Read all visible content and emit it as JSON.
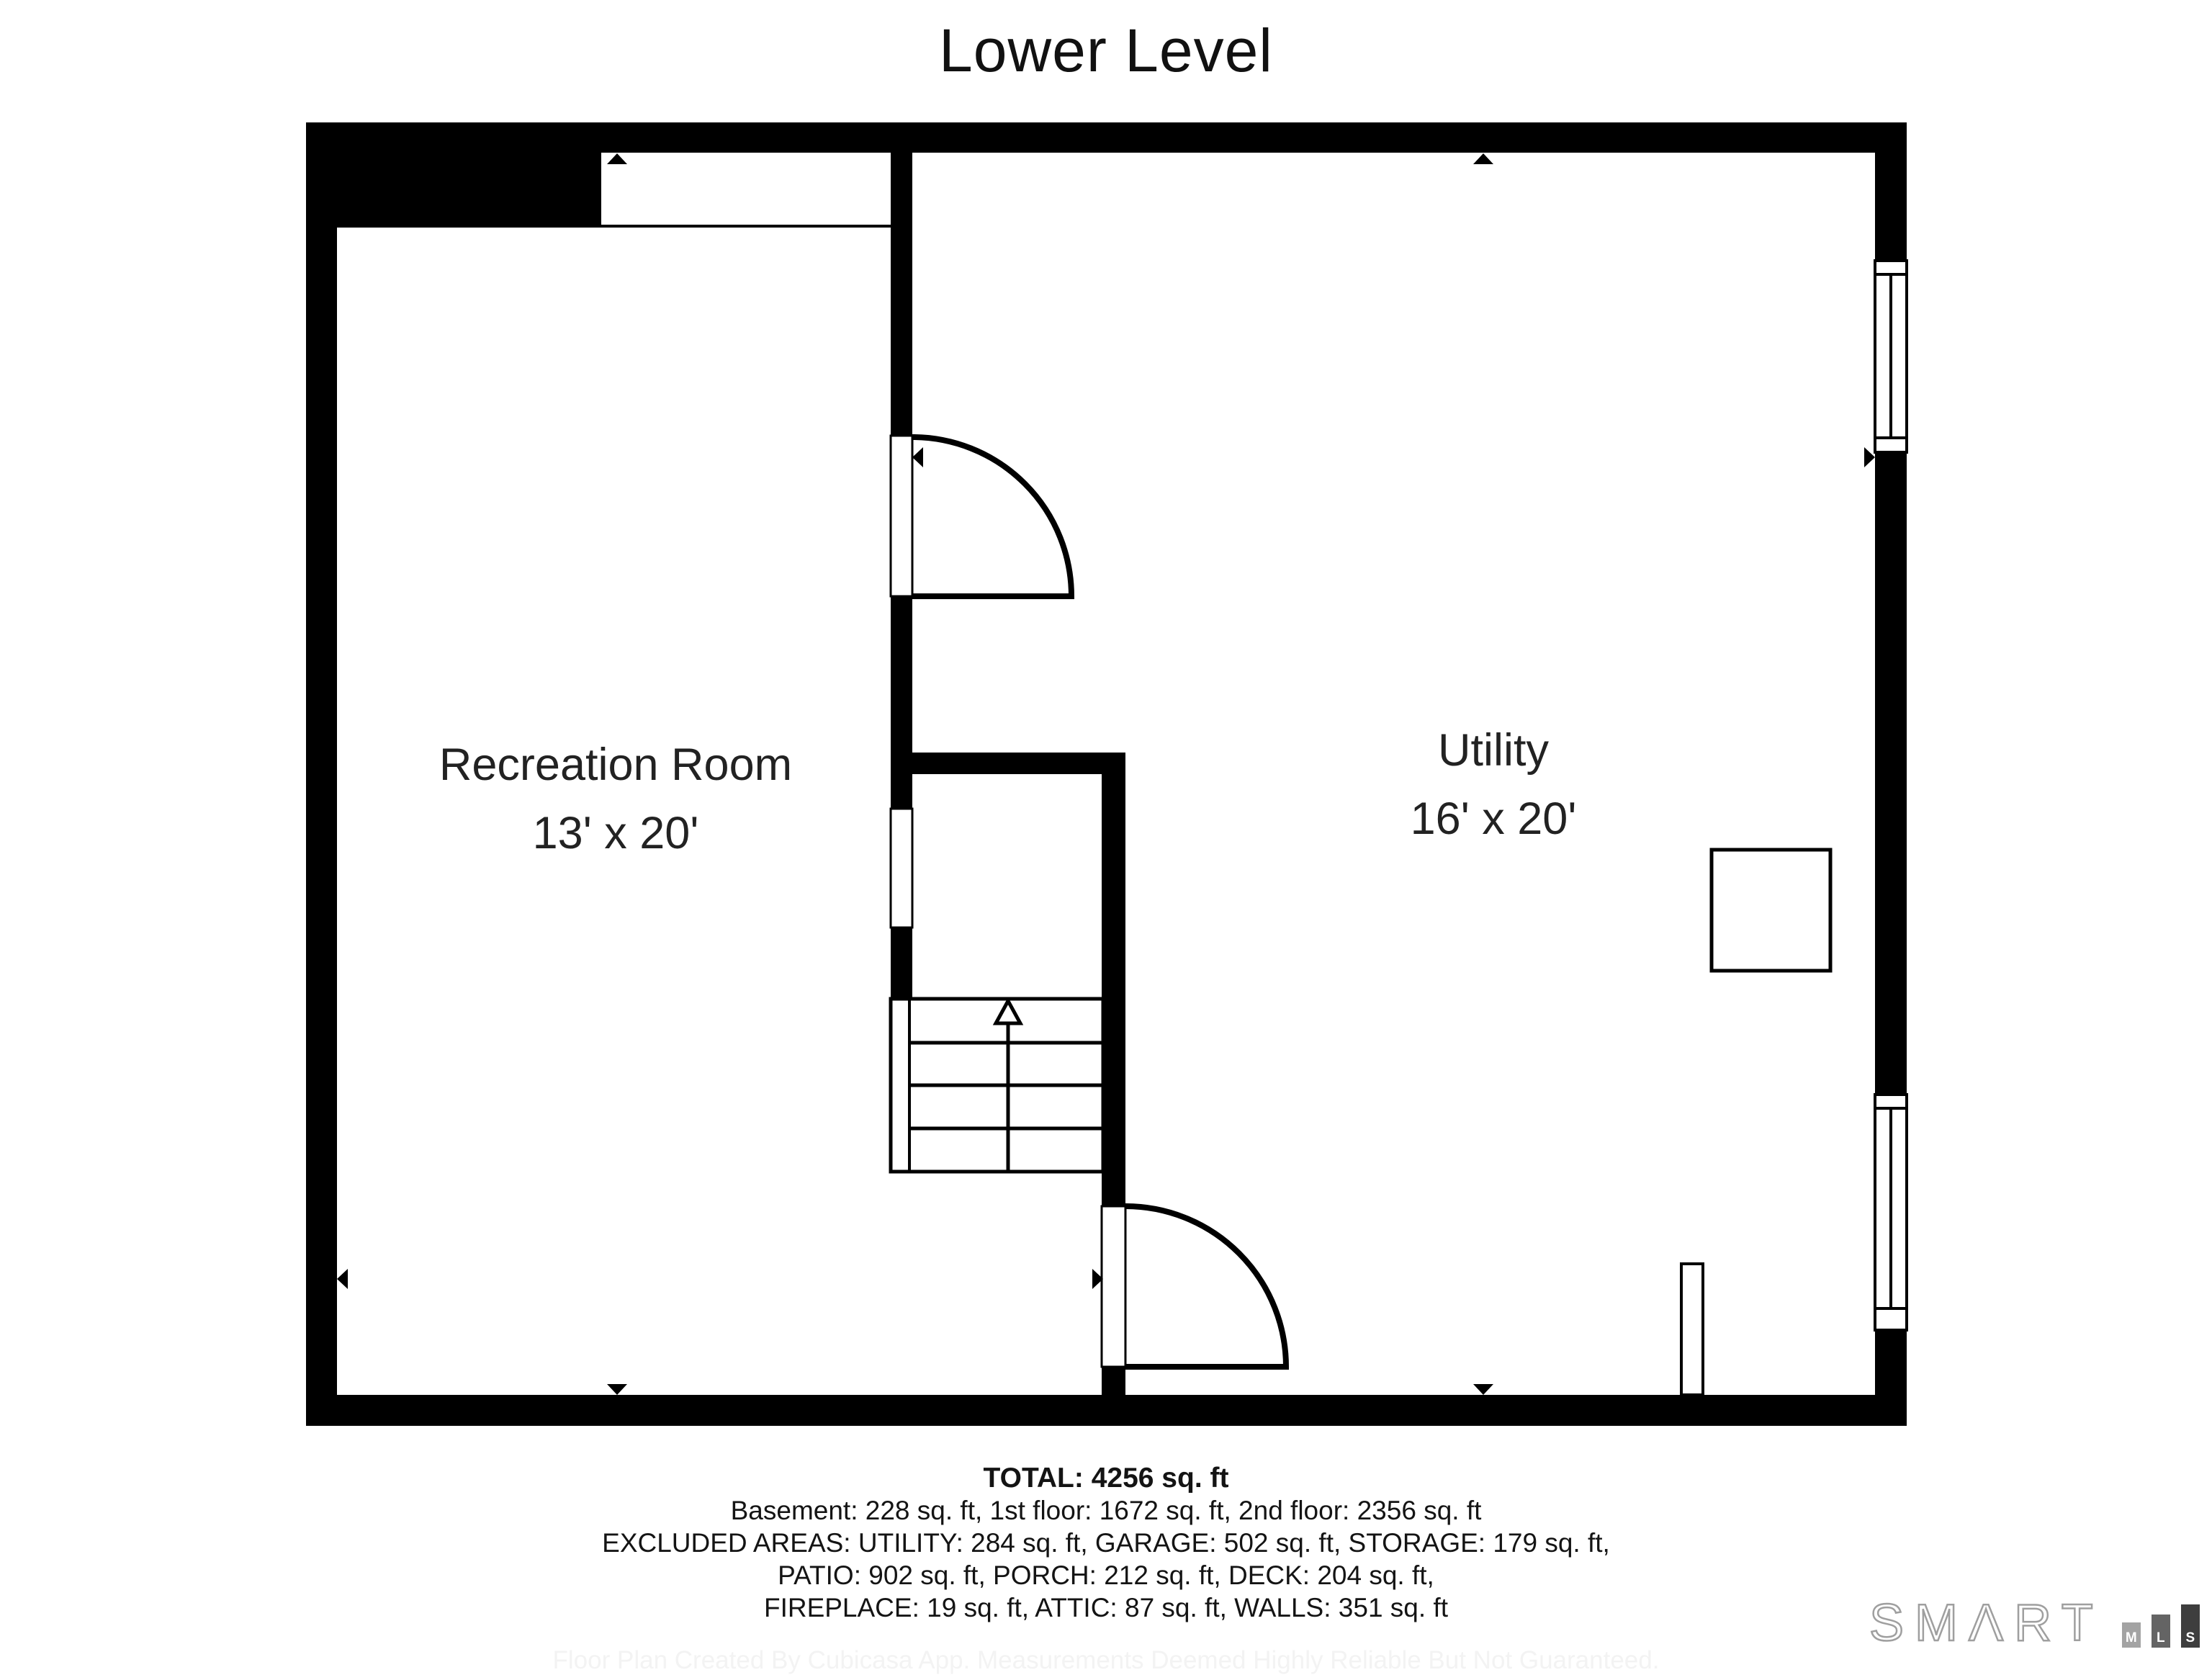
{
  "title": "Lower Level",
  "rooms": [
    {
      "name": "Recreation Room",
      "dimensions": "13' x 20'"
    },
    {
      "name": "Utility",
      "dimensions": "16' x 20'"
    }
  ],
  "summary": {
    "total": "TOTAL: 4256 sq. ft",
    "lines": [
      "Basement: 228 sq. ft, 1st floor: 1672 sq. ft, 2nd floor: 2356 sq. ft",
      "EXCLUDED AREAS: UTILITY: 284 sq. ft, GARAGE: 502 sq. ft, STORAGE: 179 sq. ft,",
      "PATIO: 902 sq. ft, PORCH: 212 sq. ft, DECK: 204 sq. ft,",
      "FIREPLACE: 19 sq. ft, ATTIC: 87 sq. ft, WALLS: 351 sq. ft"
    ]
  },
  "disclaimer": "Floor Plan Created By Cubicasa App. Measurements Deemed Highly Reliable But Not Guaranteed.",
  "logo": {
    "wordmark": "SMΛRT",
    "blocks": [
      "M",
      "L",
      "S"
    ]
  },
  "colors": {
    "wall": "#000000",
    "floor": "#ffffff",
    "text": "#141414",
    "logo_gray": "#9f9f9f",
    "logo_block_m": "#a3a3a3",
    "logo_block_l": "#646464",
    "logo_block_s": "#3e3e3e"
  }
}
